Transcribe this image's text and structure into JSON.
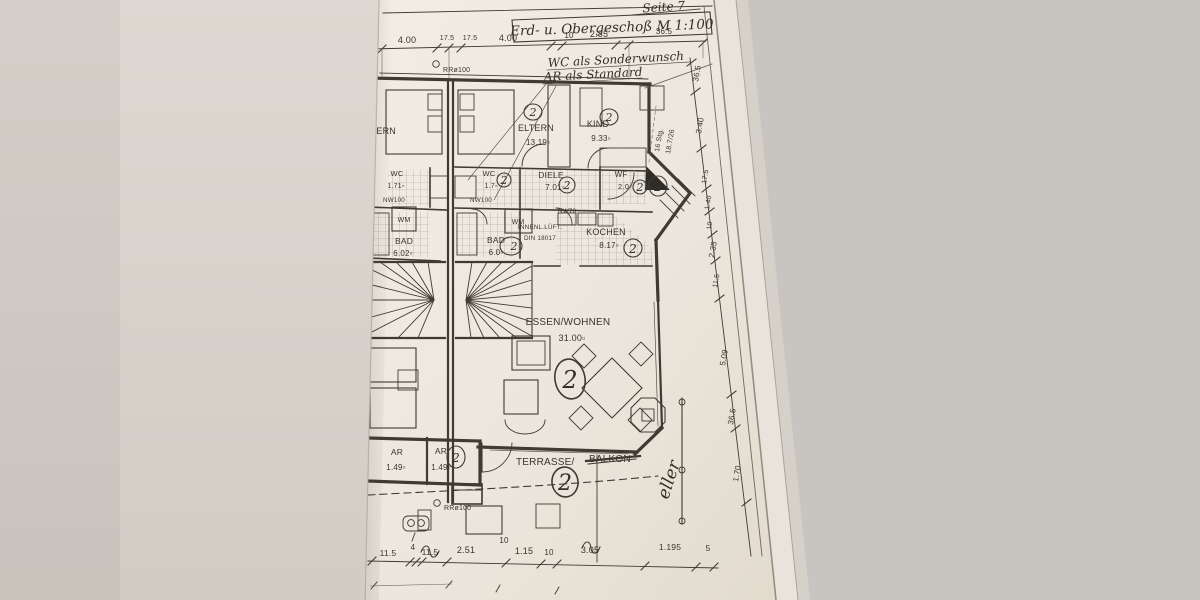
{
  "page": {
    "sheet_note": "Seite 7",
    "title": "Erd- u. Obergeschoß M 1:100"
  },
  "notes": {
    "line1": "WC als Sonderwunsch",
    "line2": "AR als Standard",
    "scribble": "eller"
  },
  "marks": {
    "unit": "2"
  },
  "rooms": {
    "eltern": {
      "name": "ELTERN",
      "area": "13.19▫"
    },
    "eltern_left": {
      "name": "ELTERN"
    },
    "kind": {
      "name": "KIND",
      "area": "9.33▫"
    },
    "diele": {
      "name": "DIELE",
      "area": "7.01▫"
    },
    "wc_right": {
      "name": "WC",
      "area": "1.7▫"
    },
    "wc_left": {
      "name": "WC",
      "area": "1.71▫"
    },
    "wf": {
      "name": "WF",
      "area": "2.0▫"
    },
    "bad_right": {
      "name": "BAD",
      "area": "6.0▫"
    },
    "bad_left": {
      "name": "BAD",
      "area": "6.02▫"
    },
    "kochen": {
      "name": "KOCHEN",
      "area": "8.17▫"
    },
    "essen": {
      "name": "ESSEN/WOHNEN",
      "area": "31.00▫"
    },
    "ar_left": {
      "name": "AR",
      "area": "1.49▫"
    },
    "ar_right": {
      "name": "AR",
      "area": "1.49▫"
    },
    "terrasse": {
      "prefix": "TERRASSE/",
      "struck": "BALKON"
    }
  },
  "tech": {
    "rr": "RRø100",
    "nw100": "NW100",
    "wm": "WM",
    "nw70": "NW70",
    "luft1": "INNENL.LÜFT.",
    "luft2": "DIN 18017",
    "stairs1": "16 Stg.",
    "stairs2": "18.7/26",
    "outlet_count": "4"
  },
  "dims": {
    "top": [
      "4.00",
      "17.5",
      "17.5",
      "4.00",
      "10",
      "2.85",
      "36.5"
    ],
    "bottom": [
      "11.5",
      "11.5",
      "2.51",
      "10",
      "1.15",
      "10",
      "3.05",
      "1.195",
      "5"
    ],
    "right": [
      "36.5",
      "3.40",
      "17.5",
      "1.40",
      "10",
      "2.35",
      "11.5",
      "5.09",
      "36.5",
      "1.70"
    ]
  }
}
